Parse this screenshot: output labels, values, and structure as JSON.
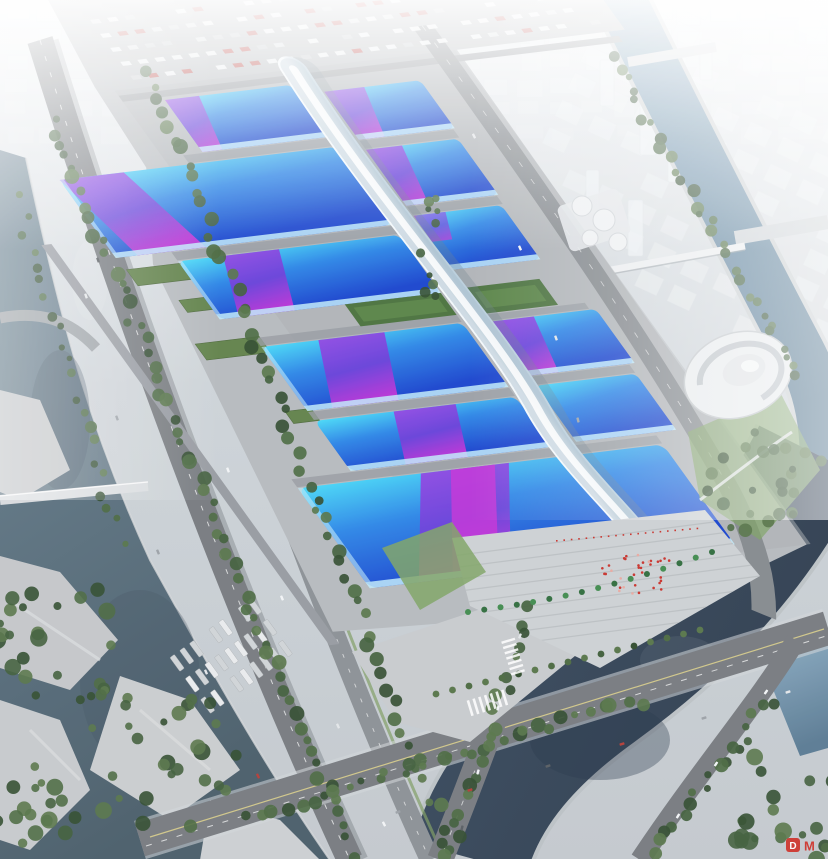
{
  "watermark": {
    "letter": "D",
    "text": "M"
  },
  "colors": {
    "base-top": "#eef1f4",
    "base-mid": "#ccd2d7",
    "base-bot": "#c2c8cd",
    "city-block": "#f3f6f8",
    "apron": "#b5b9bd",
    "apron-dark": "#a9adb2",
    "concrete": "#c8cbce",
    "road": "#75797e",
    "road-dark": "#63676c",
    "bridge-light": "#d8dbde",
    "water-left-1": "#6c8494",
    "water-left-2": "#475b68",
    "water-right-1": "#84a7c0",
    "water-right-2": "#4c708b",
    "water-dark-1": "#36485c",
    "water-dark-2": "#2c3b4d",
    "roof-cyan": "#46d7f7",
    "roof-blue": "#2a84e6",
    "roof-deep": "#1742cd",
    "roof-eave": "#bfeafb",
    "ribbon-violet": "#6d3ad9",
    "ribbon-purple": "#9a3ce2",
    "ribbon-magenta": "#c72fd6",
    "spine-white": "#f3f8fb",
    "spine-shade": "#b9cedc",
    "green-roof": "#5f8048",
    "lawn": "#7da263",
    "tree-dark": "#3c5a36",
    "palm": "#2e6b3c",
    "accent-red": "#c8302a",
    "watermark-red": "#d03028"
  }
}
